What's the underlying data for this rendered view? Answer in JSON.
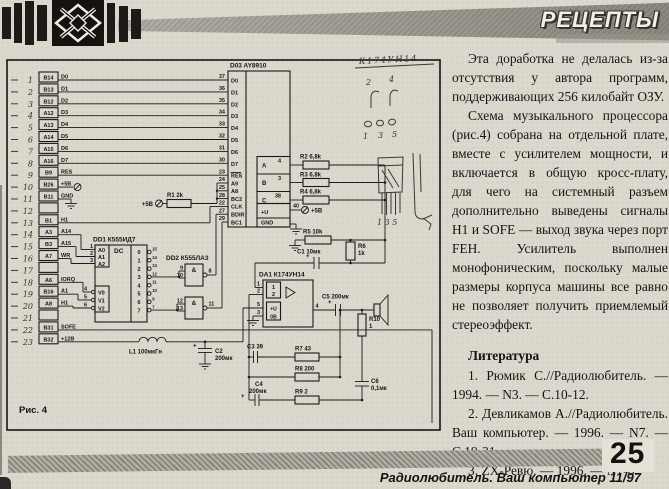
{
  "header": {
    "title": "РЕЦЕПТЫ"
  },
  "article": {
    "paragraphs": [
      "Эта доработка не делалась из-за отсутствия у автора программ, поддерживающих 256 килобайт ОЗУ.",
      "Схема музыкального процессора (рис.4) собрана на отдельной плате, вместе с усилителем мощности, и включается в общую кросс-плату, для чего на системный разъем дополнительно выведены сигналы H1 и SOFE — выход звука через порт FEH. Усилитель выполнен монофоническим, поскольку малые размеры корпуса машины все равно не позволяет получить приемлемый стереоэффект."
    ],
    "literature": {
      "heading": "Литература",
      "items": [
        "1. Рюмик С.//Радиолюбитель. — 1994. — N3. — С.10-12.",
        "2. Девликамов А.//Радиолюбитель. Ваш компьютер. — 1996. — N7. — С.19-21.",
        "3. ZX-Ревю. — 1996. — N7-8."
      ]
    }
  },
  "figure": {
    "caption": "Рис. 4",
    "connector": {
      "rows": [
        {
          "n": "1",
          "pin": "B14",
          "sig": "D0"
        },
        {
          "n": "2",
          "pin": "B13",
          "sig": "D1"
        },
        {
          "n": "3",
          "pin": "B12",
          "sig": "D2"
        },
        {
          "n": "4",
          "pin": "A12",
          "sig": "D3"
        },
        {
          "n": "5",
          "pin": "A13",
          "sig": "D4"
        },
        {
          "n": "6",
          "pin": "A14",
          "sig": "D5"
        },
        {
          "n": "7",
          "pin": "A15",
          "sig": "D6"
        },
        {
          "n": "8",
          "pin": "A16",
          "sig": "D7"
        },
        {
          "n": "9",
          "pin": "B9",
          "sig": "RES"
        },
        {
          "n": "10",
          "pin": "B26",
          "sig": "+5В"
        },
        {
          "n": "11",
          "pin": "B11",
          "sig": "GND"
        },
        {
          "n": "12",
          "pin": "",
          "sig": ""
        },
        {
          "n": "13",
          "pin": "B1",
          "sig": "H1"
        },
        {
          "n": "14",
          "pin": "A3",
          "sig": "A14"
        },
        {
          "n": "15",
          "pin": "B3",
          "sig": "A15"
        },
        {
          "n": "16",
          "pin": "A7",
          "sig": "WR"
        },
        {
          "n": "17",
          "pin": "",
          "sig": ""
        },
        {
          "n": "18",
          "pin": "A6",
          "sig": "IORQ"
        },
        {
          "n": "19",
          "pin": "B16",
          "sig": "A1"
        },
        {
          "n": "20",
          "pin": "A8",
          "sig": "H1"
        },
        {
          "n": "21",
          "pin": "",
          "sig": ""
        },
        {
          "n": "22",
          "pin": "B31",
          "sig": "SOFE"
        },
        {
          "n": "23",
          "pin": "B32",
          "sig": "+12В"
        }
      ]
    },
    "d03": {
      "ref": "D03 AY8910",
      "data_pins": [
        {
          "num": "37",
          "name": "D0"
        },
        {
          "num": "36",
          "name": "D1"
        },
        {
          "num": "35",
          "name": "D2"
        },
        {
          "num": "34",
          "name": "D3"
        },
        {
          "num": "33",
          "name": "D4"
        },
        {
          "num": "32",
          "name": "D5"
        },
        {
          "num": "31",
          "name": "D6"
        },
        {
          "num": "30",
          "name": "D7"
        }
      ],
      "ctrl_pins": [
        {
          "num": "23",
          "name": "RES"
        },
        {
          "num": "24",
          "name": "A9"
        },
        {
          "num": "25",
          "name": "A8"
        },
        {
          "num": "28",
          "name": "BC2"
        },
        {
          "num": "22",
          "name": "CLK"
        },
        {
          "num": "27",
          "name": "BDIR"
        },
        {
          "num": "29",
          "name": "BC1"
        }
      ],
      "out_pins": [
        {
          "name": "A",
          "num": "4"
        },
        {
          "name": "B",
          "num": "3"
        },
        {
          "name": "C",
          "num": "38"
        }
      ],
      "power_label": "+U",
      "power_pin": "40",
      "power_supply": "+5В",
      "gnd_label": "GND"
    },
    "dd1": {
      "ref": "DD1 К555ИД7",
      "func": "DC",
      "a_inputs": [
        {
          "num": "1",
          "name": "A0"
        },
        {
          "num": "2",
          "name": "A1"
        },
        {
          "num": "3",
          "name": "A2"
        }
      ],
      "v_inputs": [
        {
          "num": "4",
          "name": "V0"
        },
        {
          "num": "5",
          "name": "V1"
        },
        {
          "num": "6",
          "name": "V2"
        }
      ],
      "outputs": [
        {
          "name": "0",
          "num": "15"
        },
        {
          "name": "1",
          "num": "14"
        },
        {
          "name": "2",
          "num": "13"
        },
        {
          "name": "3",
          "num": "12"
        },
        {
          "name": "4",
          "num": "11"
        },
        {
          "name": "5",
          "num": "10"
        },
        {
          "name": "6",
          "num": "9"
        },
        {
          "name": "7",
          "num": "7"
        }
      ]
    },
    "dd2": {
      "ref": "DD2 К555ЛА3",
      "gates": [
        {
          "sym": "&",
          "in1": "9",
          "in2": "10",
          "out": "8"
        },
        {
          "sym": "&",
          "in1": "12",
          "in2": "13",
          "out": "11"
        }
      ]
    },
    "da1": {
      "ref": "DA1 К174УН14",
      "pin_in1": "1",
      "pin_in2": "2",
      "pin_vcc": "5",
      "pin_gnd": "3",
      "pin_out": "4",
      "lbl_in1": "1",
      "lbl_in2": "2",
      "lbl_vcc": "+U",
      "lbl_gnd": "0В"
    },
    "parts": {
      "r1": "R1 2k",
      "r2": "R2 6,8k",
      "r3": "R3 6,8k",
      "r4": "R4 6,8k",
      "r5": "R5 10k",
      "r6_name": "R6",
      "r6_val": "1k",
      "r7": "R7 43",
      "r8": "R8 200",
      "r9": "R9 2",
      "r10_name": "R10",
      "r10_val": "1",
      "c1": "C1 10мк",
      "c2_name": "C2",
      "c2_val": "200мк",
      "c3": "C3 39",
      "c4_name": "C4",
      "c4_val": "200мк",
      "c5": "C5 200мк",
      "c6_name": "C6",
      "c6_val": "0,1мк",
      "l1": "L1 100мкГн",
      "plus5_r1": "+5В",
      "plus5_vcc": "+5В"
    },
    "handwritten": {
      "title": "К174УН14",
      "top_left": "2",
      "top_right": "4",
      "c1": "1",
      "c2": "3",
      "c3": "5",
      "legs": "1 3 5"
    }
  },
  "footer": {
    "page_number": "25",
    "journal": "Радиолюбитель. Ваш компьютер 11/97"
  }
}
